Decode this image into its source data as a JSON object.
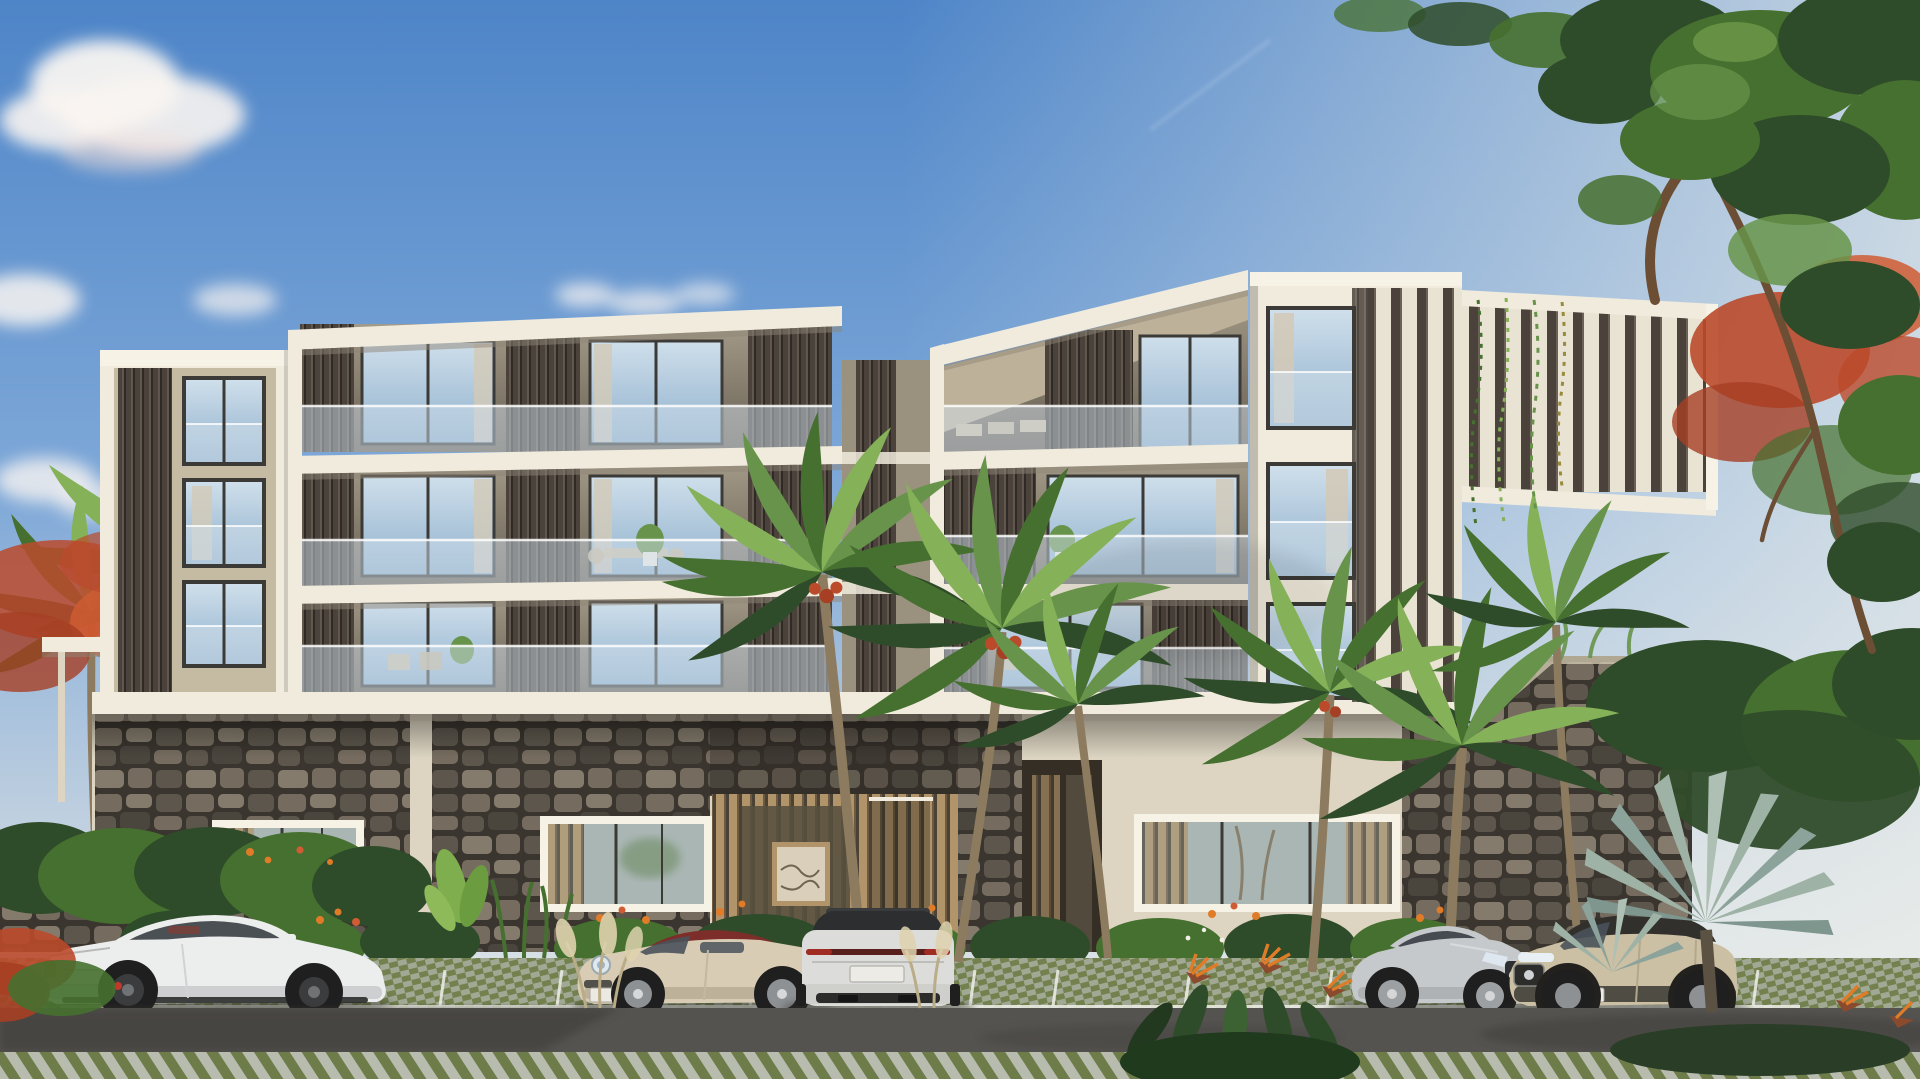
{
  "meta": {
    "domain": "architectural-exterior-render",
    "description": "Photorealistic architectural rendering of a modern four-storey tropical apartment residence with staggered cream volumes, dark bronze vertical louvers, glass balcony balustrades, lava-stone base walls, palm trees and five luxury cars parked on grass-paver stalls in front, under a blue late-afternoon sky.",
    "width_px": 1920,
    "height_px": 1079,
    "time_of_day": "late afternoon"
  },
  "scene": {
    "sky": {
      "cloud_clusters": 5,
      "has_faint_contrail": true
    },
    "building": {
      "style": "contemporary stacked volumes",
      "storeys": 4,
      "features": [
        "cream white concrete fascias",
        "dark bronze vertical louver screens",
        "frameless glass balcony balustrades",
        "floor-to-ceiling sliding glass doors with sheer curtains",
        "angled roof soffit over right penthouse balcony",
        "white vertical fin screen wing on right end",
        "volcanic lava-stone ground floor cladding",
        "timber slat entrance lobby with framed artwork",
        "second recessed timber entrance door"
      ]
    },
    "vehicles": [
      {
        "id": "bmw-coupe",
        "type": "sports coupe",
        "color_name": "white",
        "facing": "right",
        "details": "dark wheels, red brake calipers, red interior visible"
      },
      {
        "id": "porsche-911",
        "type": "convertible",
        "color_name": "cream",
        "facing": "left",
        "details": "dark red fabric soft top, round LED headlight"
      },
      {
        "id": "cayenne-suv",
        "type": "coupe SUV (rear view)",
        "color_name": "silver white",
        "facing": "away",
        "details": "black glass roof, full-width tail light bar, dual exhaust"
      },
      {
        "id": "mercedes-coupe",
        "type": "luxury coupe",
        "color_name": "silver",
        "facing": "right",
        "details": "chrome studded grille with star badge"
      },
      {
        "id": "champagne-suv",
        "type": "compact SUV",
        "color_name": "champagne beige",
        "facing": "left",
        "details": "black lower cladding, dark glass roof"
      }
    ],
    "vegetation": [
      "coconut palms with red seed clusters in front of facade",
      "large leafy tree overhanging from top right corner",
      "red flowering flame trees left and right",
      "silver bismarck fan palm in right foreground",
      "bird-of-paradise clumps with orange flowers",
      "clipped hedge and lava-stone garden wall on left",
      "banana plant and heliconia planting bed along the base",
      "pampas grass tufts",
      "vines hanging over right fin screen"
    ],
    "ground": {
      "parking_surface": "green grass-paver grid with white stall lines",
      "road": "asphalt with tree shadows",
      "foreground": "diagonal paver and grass strip"
    }
  },
  "palette": {
    "sky_top": "#4e85c8",
    "sky_mid": "#7ea8d8",
    "sky_low": "#c3d2e0",
    "horizon": "#eceeea",
    "cloud": "#f8f4f1",
    "cloud_pink": "#f0dfd8",
    "facade_light": "#f0ebdc",
    "facade_bright": "#f6f2e6",
    "facade_cream": "#ddd5c2",
    "fascia_shadow": "#8f8677",
    "stucco_tan": "#c5bba3",
    "soffit_tan": "#bdb299",
    "louver_dark": "#4b433b",
    "louver_mid": "#6b6156",
    "louver_gap": "#2f2a25",
    "fin_light": "#e9e3d4",
    "glass_hi": "#cfdfeb",
    "glass_lo": "#8fb0cc",
    "glass_gf": "#a9b6b3",
    "balustrade": "#cfdeea",
    "interior_hi": "#a39a88",
    "interior_lo": "#675f52",
    "curtain": "#d3c9b6",
    "frame_dark": "#3b3a36",
    "stone_joint": "#3a352e",
    "stone_a": "#756c5f",
    "stone_b": "#5c564c",
    "stone_c": "#847b6d",
    "stone_d": "#4a453d",
    "wood_hi": "#b2946a",
    "wood_lo": "#6e5a40",
    "entrance_dark": "#4b4236",
    "leaf_dark": "#2f4c2a",
    "leaf_mid": "#46702f",
    "leaf_light": "#67944a",
    "palm_light": "#85b159",
    "bismarck": "#9eb2a6",
    "trunk": "#8d7b5f",
    "branch": "#6b4e33",
    "flame_red": "#bb4a2b",
    "flame_red2": "#cf5c33",
    "flame_dark": "#a63f24",
    "flower_orange": "#e07b28",
    "plume": "#ded2ae",
    "asphalt": "#555350",
    "road_shadow": "#3c3b39",
    "paver_green": "#72814d",
    "paver_grey": "#a7ac9b",
    "paver_grey2": "#b8bcae",
    "paver_green2": "#6d7c49",
    "stall_line": "#eff0e9",
    "car_white": "#eceded",
    "car_white_sh": "#c5c7c8",
    "car_cream": "#d9ccb4",
    "car_cream_sh": "#b9ac94",
    "car_silver": "#c6c9cc",
    "car_champagne": "#cbbfa4",
    "roof_red": "#7e2e2a",
    "tire": "#1f1f1f",
    "rim": "#8e9194",
    "shadow": "#2e2d2b"
  }
}
